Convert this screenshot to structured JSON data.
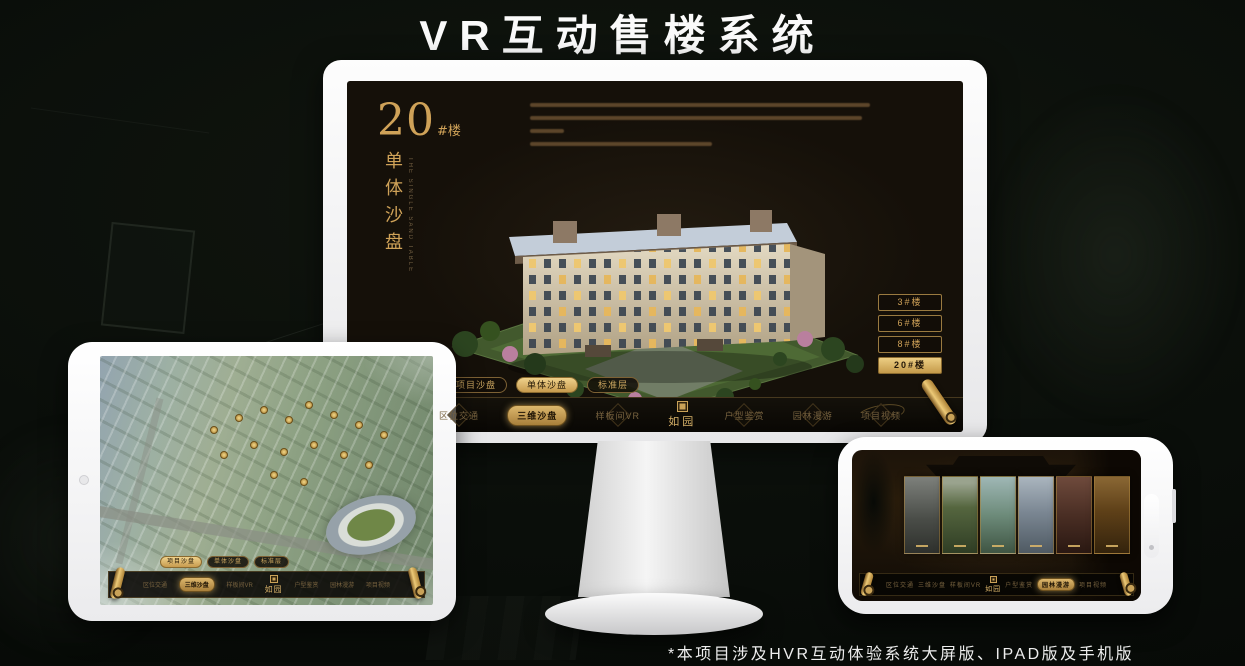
{
  "page": {
    "title": "VR互动售楼系统",
    "footnote": "*本项目涉及HVR互动体验系统大屏版、IPAD版及手机版"
  },
  "colors": {
    "gold": "#d2a85e",
    "gold_bright": "#ecc977",
    "screen_bg": "#151009",
    "page_bg": "#0a0e0a"
  },
  "monitor": {
    "floor_heading": {
      "number": "20",
      "suffix": "#楼"
    },
    "vertical_title": "单体沙盘",
    "vertical_subtitle": "THE SINGLE SAND TABLE",
    "floor_buttons": [
      {
        "label": "3#楼",
        "active": false
      },
      {
        "label": "6#楼",
        "active": false
      },
      {
        "label": "8#楼",
        "active": false
      },
      {
        "label": "20#楼",
        "active": true
      }
    ],
    "tabs": [
      {
        "label": "项目沙盘",
        "active": false
      },
      {
        "label": "单体沙盘",
        "active": true
      },
      {
        "label": "标准层",
        "active": false
      }
    ],
    "nav": {
      "logo": "如园",
      "items": [
        {
          "label": "区位交通",
          "active": false
        },
        {
          "label": "三维沙盘",
          "active": true
        },
        {
          "label": "样板间VR",
          "active": false
        },
        {
          "label": "户型鉴赏",
          "active": false
        },
        {
          "label": "园林漫游",
          "active": false
        },
        {
          "label": "项目视频",
          "active": false
        }
      ]
    }
  },
  "tablet": {
    "tabs": [
      {
        "label": "项目沙盘",
        "active": true
      },
      {
        "label": "单体沙盘",
        "active": false
      },
      {
        "label": "标准层",
        "active": false
      }
    ],
    "nav": {
      "logo": "如园",
      "items": [
        {
          "label": "区位交通",
          "active": false
        },
        {
          "label": "三维沙盘",
          "active": true
        },
        {
          "label": "样板间VR",
          "active": false
        },
        {
          "label": "户型鉴赏",
          "active": false
        },
        {
          "label": "园林漫游",
          "active": false
        },
        {
          "label": "项目视频",
          "active": false
        }
      ]
    }
  },
  "phone": {
    "nav": {
      "logo": "如园",
      "items": [
        {
          "label": "区位交通",
          "active": false
        },
        {
          "label": "三维沙盘",
          "active": false
        },
        {
          "label": "样板间VR",
          "active": false
        },
        {
          "label": "户型鉴赏",
          "active": false
        },
        {
          "label": "园林漫游",
          "active": true
        },
        {
          "label": "项目视频",
          "active": false
        }
      ]
    }
  }
}
